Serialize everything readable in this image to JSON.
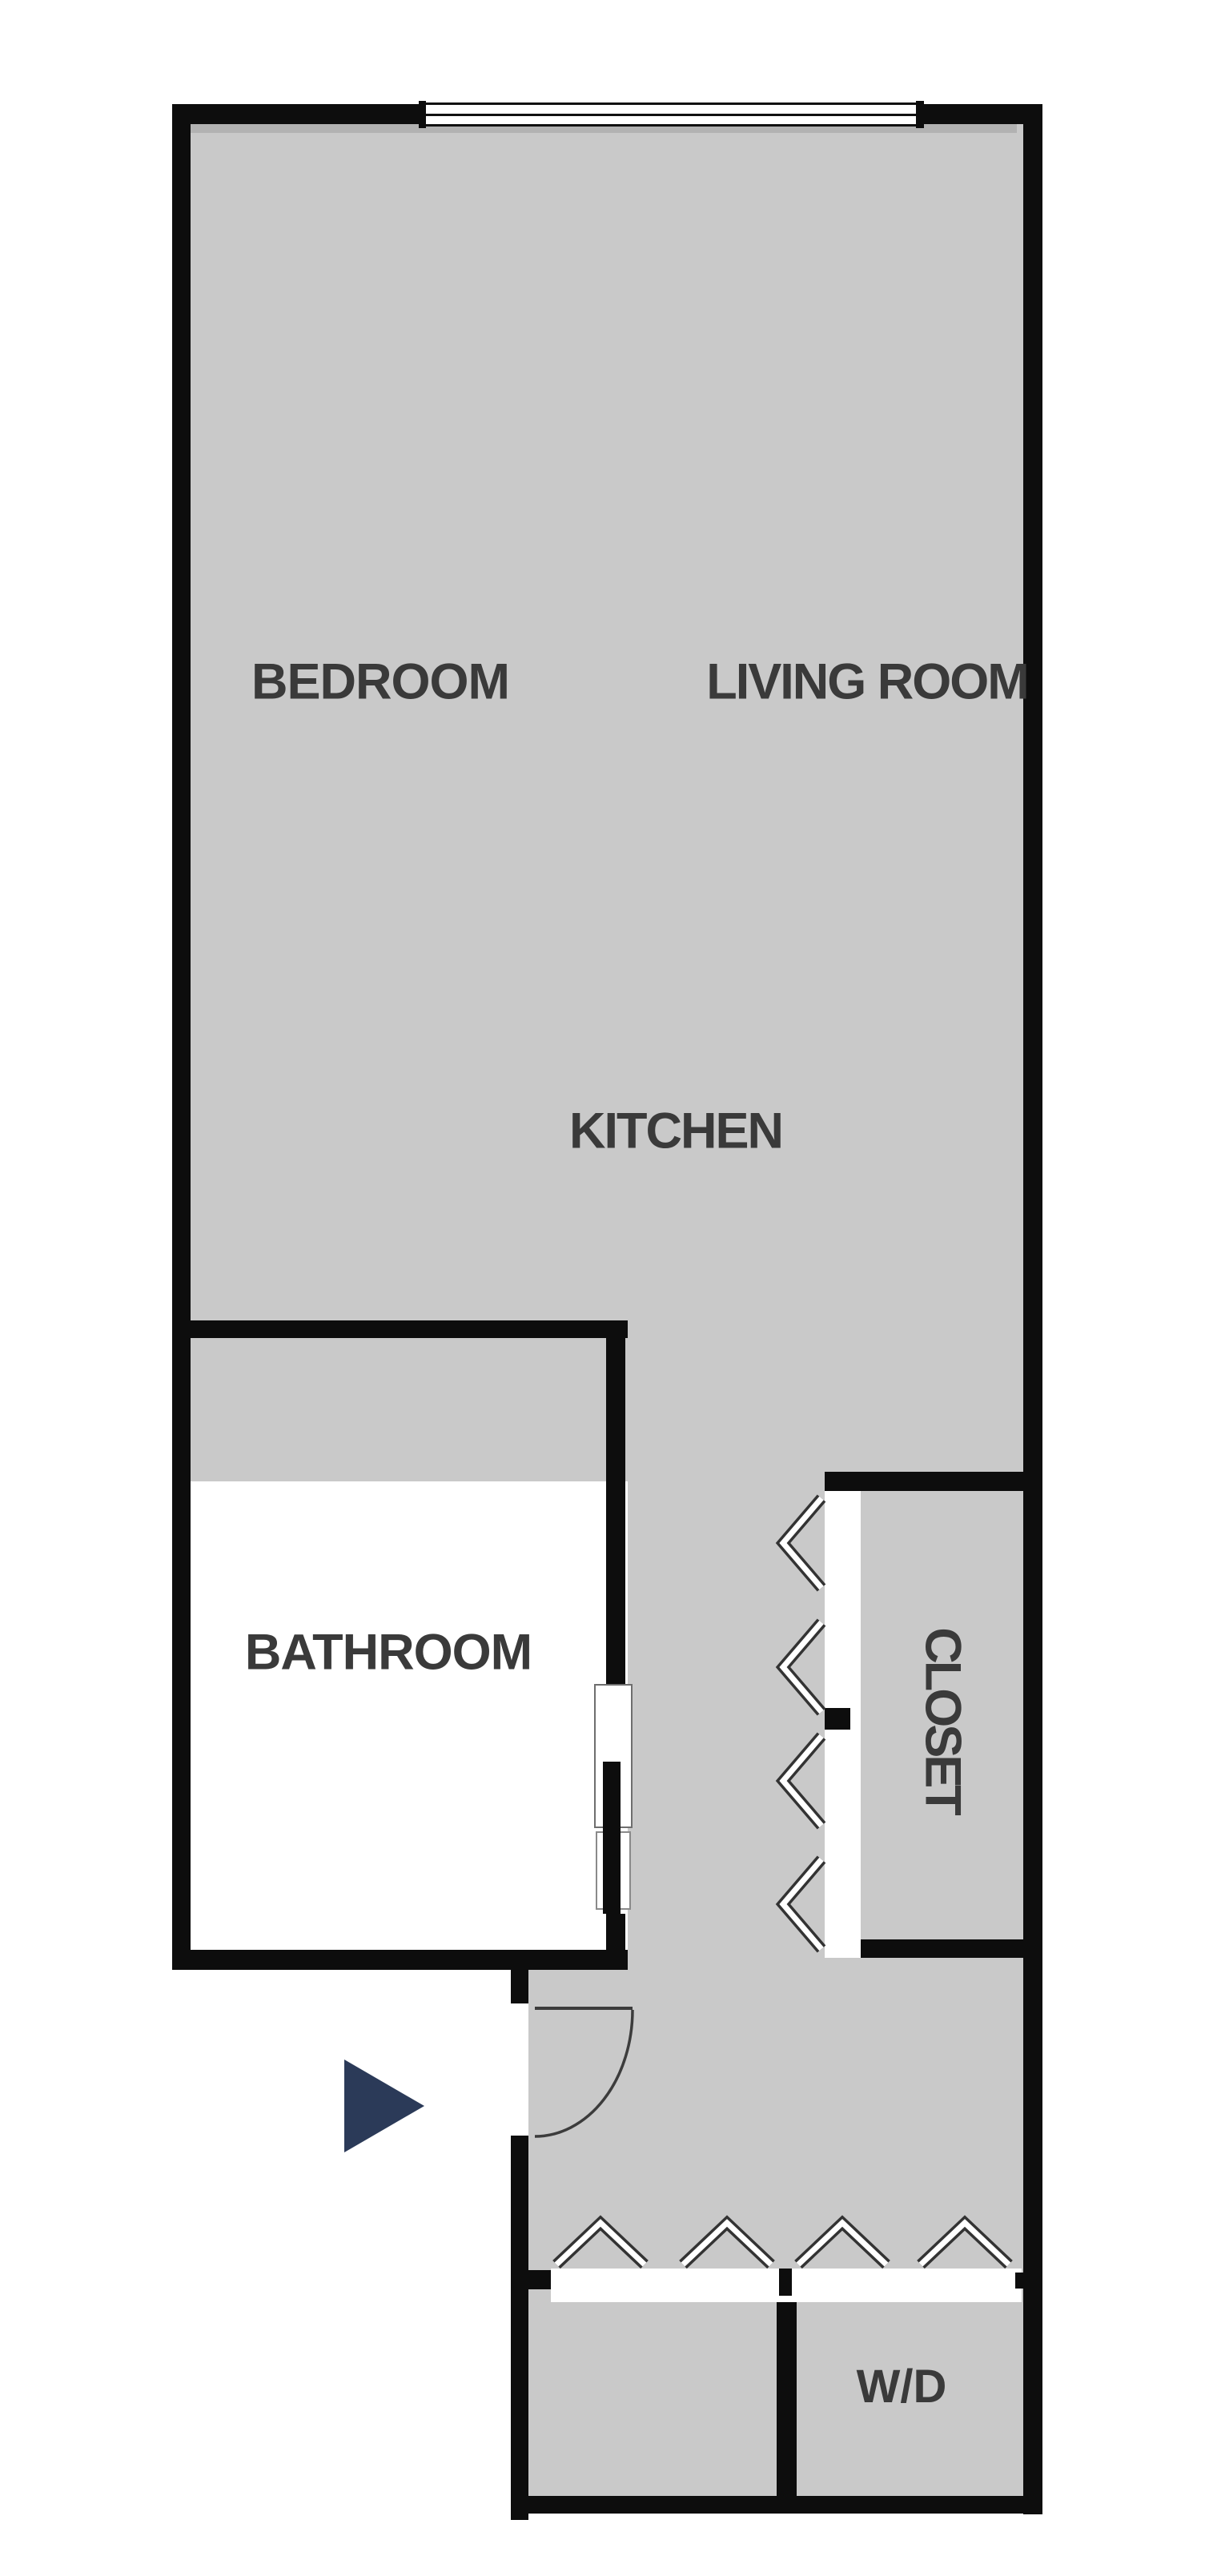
{
  "floorplan": {
    "rooms": {
      "bedroom": "BEDROOM",
      "living_room": "LIVING ROOM",
      "kitchen": "KITCHEN",
      "bathroom": "BATHROOM",
      "closet": "CLOSET",
      "washer_dryer": "W/D"
    },
    "icons": {
      "entry_arrow": "right-pointing-triangle",
      "bifold_door": "double-bar-chevron",
      "door_swing": "quarter-circle-arc",
      "window": "triple-line-band"
    },
    "colors": {
      "background": "#ffffff",
      "floor": "#c9c9c9",
      "wall": "#0d0d0d",
      "label": "#3a3a3a",
      "entry_arrow": "#2b3a58",
      "door_outline": "#3c3c3c",
      "window_frame": "#111111",
      "wall_shadow": "#a9a9a9"
    }
  }
}
